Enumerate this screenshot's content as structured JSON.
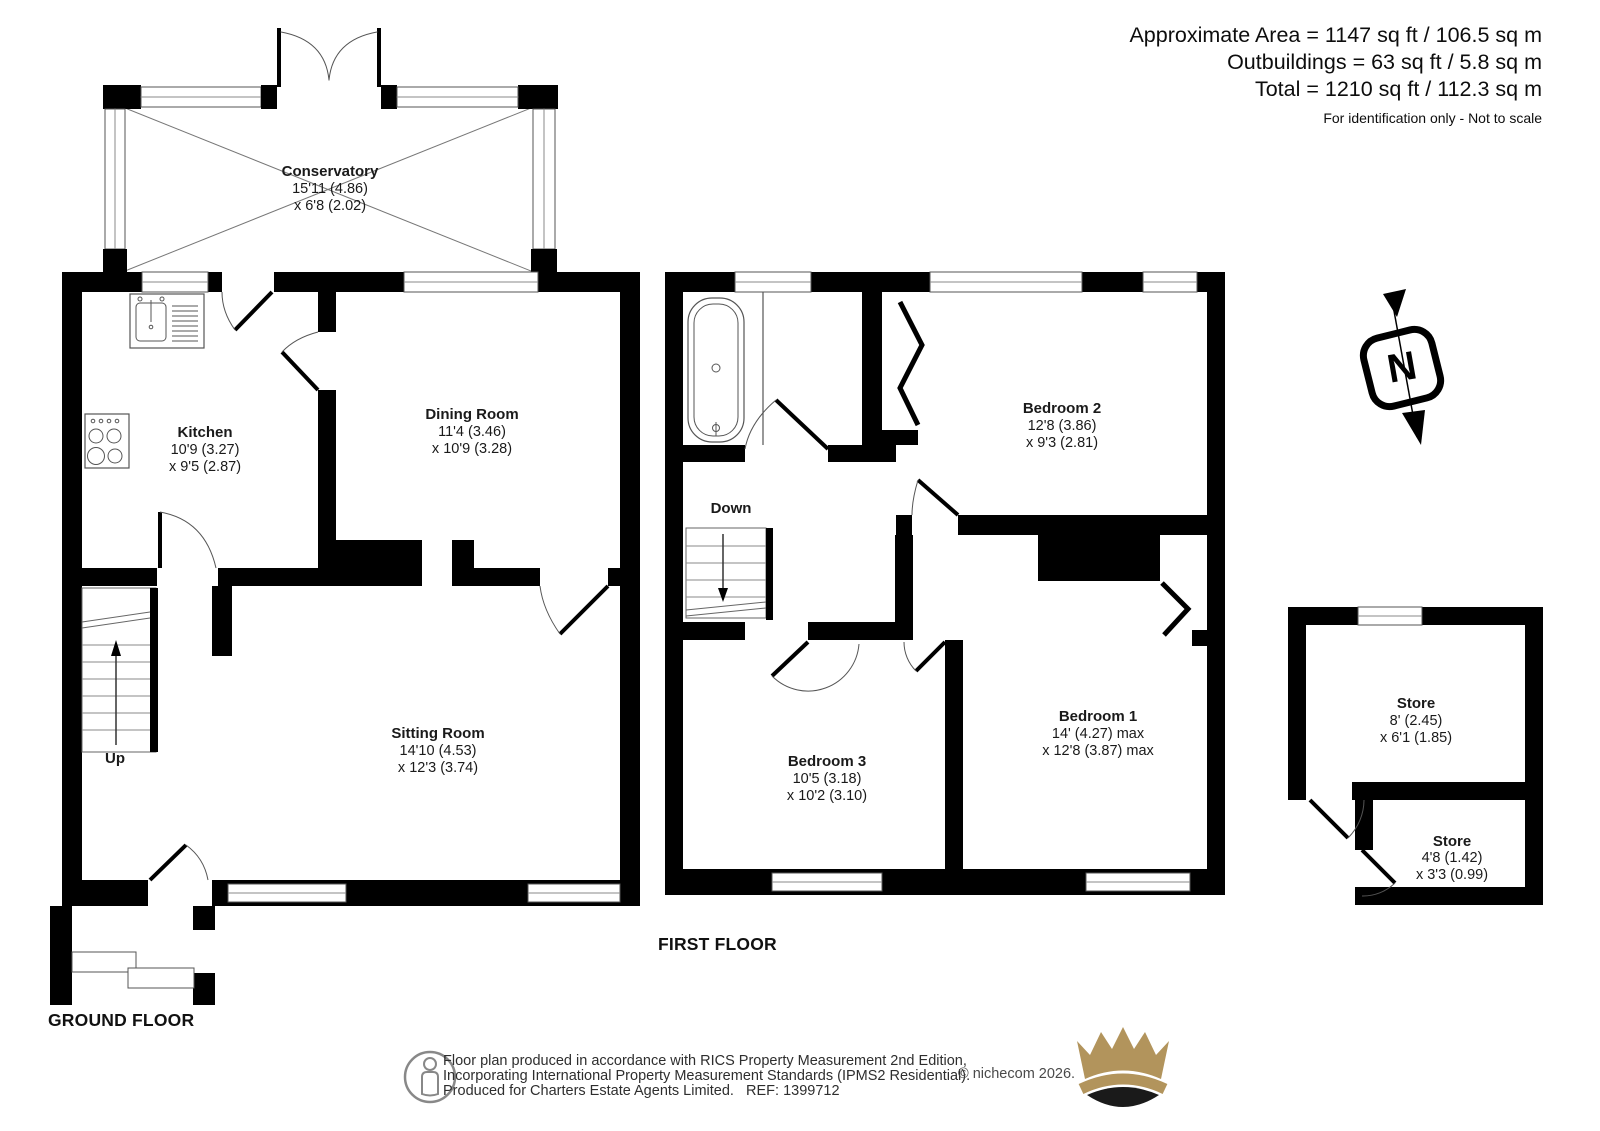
{
  "header": {
    "line1": "Approximate Area = 1147 sq ft / 106.5 sq m",
    "line2": "Outbuildings = 63 sq ft / 5.8 sq m",
    "line3": "Total = 1210 sq ft / 112.3 sq m",
    "note": "For identification only - Not to scale"
  },
  "floors": {
    "ground": "GROUND FLOOR",
    "first": "FIRST FLOOR"
  },
  "rooms": {
    "conservatory": {
      "name": "Conservatory",
      "dim1": "15'11 (4.86)",
      "dim2": "x 6'8 (2.02)"
    },
    "kitchen": {
      "name": "Kitchen",
      "dim1": "10'9 (3.27)",
      "dim2": "x 9'5 (2.87)"
    },
    "dining": {
      "name": "Dining Room",
      "dim1": "11'4 (3.46)",
      "dim2": "x 10'9 (3.28)"
    },
    "sitting": {
      "name": "Sitting Room",
      "dim1": "14'10 (4.53)",
      "dim2": "x 12'3 (3.74)"
    },
    "bedroom1": {
      "name": "Bedroom 1",
      "dim1": "14' (4.27) max",
      "dim2": "x 12'8 (3.87) max"
    },
    "bedroom2": {
      "name": "Bedroom 2",
      "dim1": "12'8 (3.86)",
      "dim2": "x 9'3 (2.81)"
    },
    "bedroom3": {
      "name": "Bedroom 3",
      "dim1": "10'5 (3.18)",
      "dim2": "x 10'2 (3.10)"
    },
    "store1": {
      "name": "Store",
      "dim1": "8' (2.45)",
      "dim2": "x 6'1 (1.85)"
    },
    "store2": {
      "name": "Store",
      "dim1": "4'8 (1.42)",
      "dim2": "x 3'3 (0.99)"
    }
  },
  "stairs": {
    "up": "Up",
    "down": "Down"
  },
  "compass": {
    "label": "N"
  },
  "footer": {
    "line1": "Floor plan produced in accordance with RICS Property Measurement 2nd Edition,",
    "line2": "Incorporating International Property Measurement Standards (IPMS2 Residential).",
    "line3": "Produced for Charters Estate Agents Limited.   REF: 1399712",
    "copyright": "© nichecom 2026."
  },
  "colors": {
    "wall": "#000000",
    "thin_line": "#555555",
    "gold": "#b2945c"
  }
}
